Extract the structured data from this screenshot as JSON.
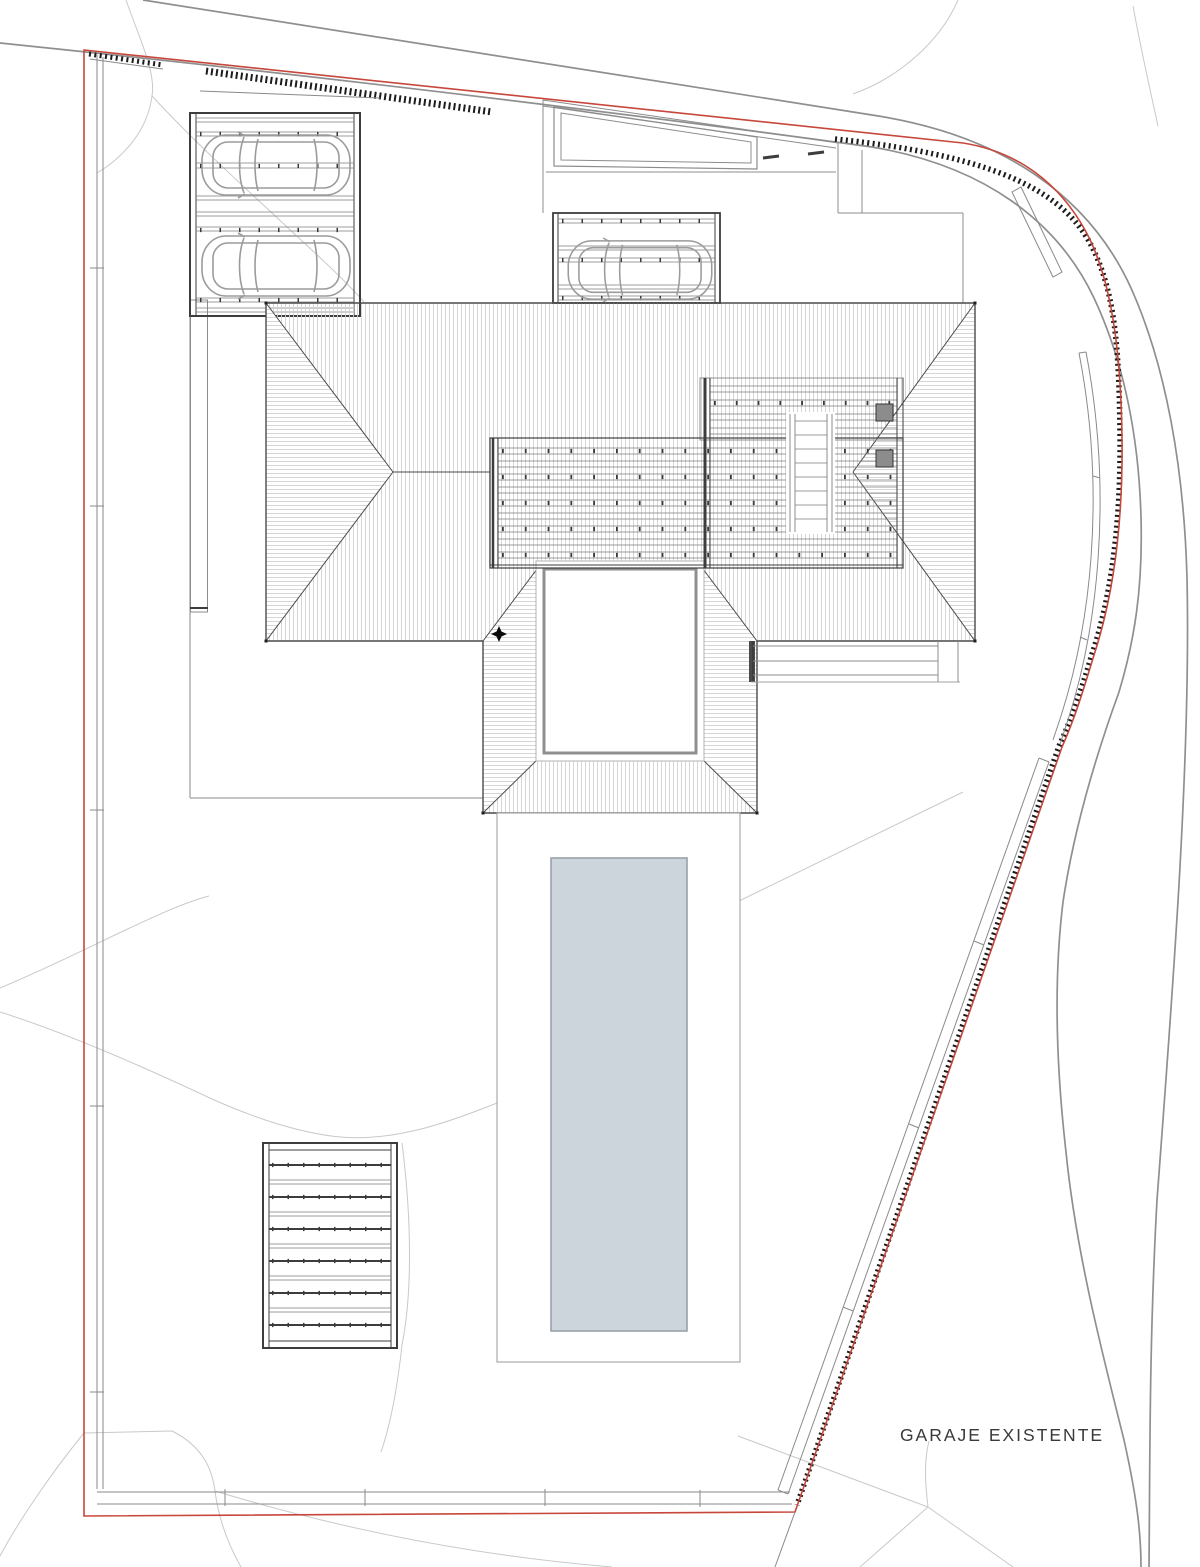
{
  "page": {
    "width": 1200,
    "height": 1567,
    "background": "#ffffff"
  },
  "labels": {
    "garaje_existente": "GARAJE EXISTENTE"
  },
  "colors": {
    "boundary": "#c7473b",
    "fence_hatch": "#1c1c1c",
    "road": "#8f8f8f",
    "contour": "#c9c9c9",
    "wall": "#8a8a8a",
    "structure": "#3d3d3d",
    "structure_light": "#8c8c8c",
    "car": "#9b9b9b",
    "roof_hatch": "#d2d2d2",
    "roof_edge": "#4a4a4a",
    "pool_fill": "#cdd5dc",
    "pool_edge": "#9aa2a9",
    "deck_edge": "#a3a3a3",
    "text": "#3a3a3a"
  },
  "objects": {
    "cars": 3,
    "pools": 1
  }
}
